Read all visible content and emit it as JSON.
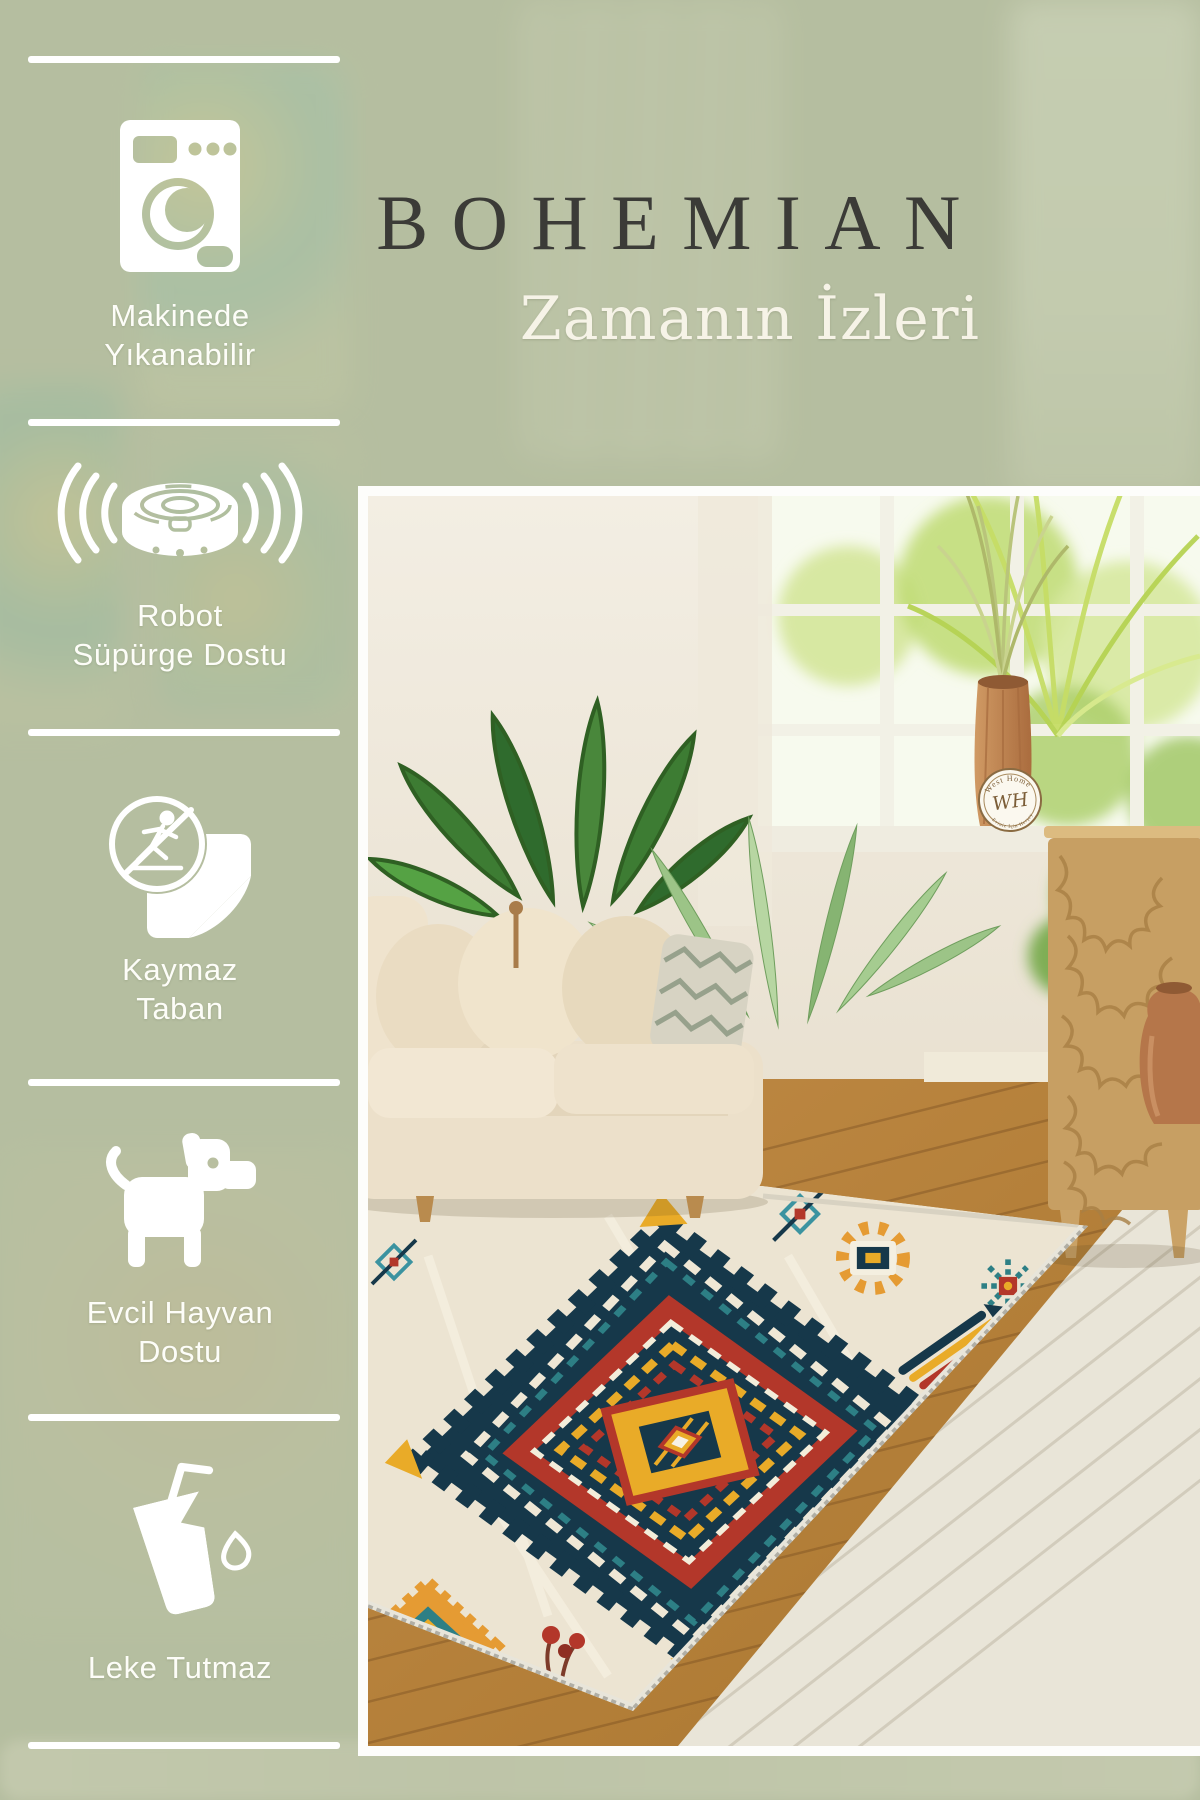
{
  "header": {
    "title": "BOHEMIAN",
    "subtitle": "Zamanın İzleri"
  },
  "features": [
    {
      "icon": "washing-machine-icon",
      "line1": "Makinede",
      "line2": "Yıkanabilir"
    },
    {
      "icon": "robot-vacuum-icon",
      "line1": "Robot",
      "line2": "Süpürge Dostu"
    },
    {
      "icon": "non-slip-base-icon",
      "line1": "Kaymaz",
      "line2": "Taban"
    },
    {
      "icon": "dog-icon",
      "line1": "Evcil Hayvan",
      "line2": "Dostu"
    },
    {
      "icon": "spill-glass-icon",
      "line1": "Leke Tutmaz",
      "line2": ""
    }
  ],
  "watermark": {
    "brand_top": "West Home",
    "monogram": "WH",
    "brand_bottom": "Eviniz İçin Herşey"
  },
  "colors": {
    "overlay_sage": "#b7bfa2",
    "title_ink": "#3b3b37",
    "text_white": "#ffffff",
    "rug_navy": "#16384a",
    "rug_teal": "#2d7f85",
    "rug_red": "#b3372a",
    "rug_yellow": "#e9ab28",
    "rug_cream": "#ece4d2",
    "wood_warm": "#b5813f",
    "terracotta": "#b5764a"
  }
}
